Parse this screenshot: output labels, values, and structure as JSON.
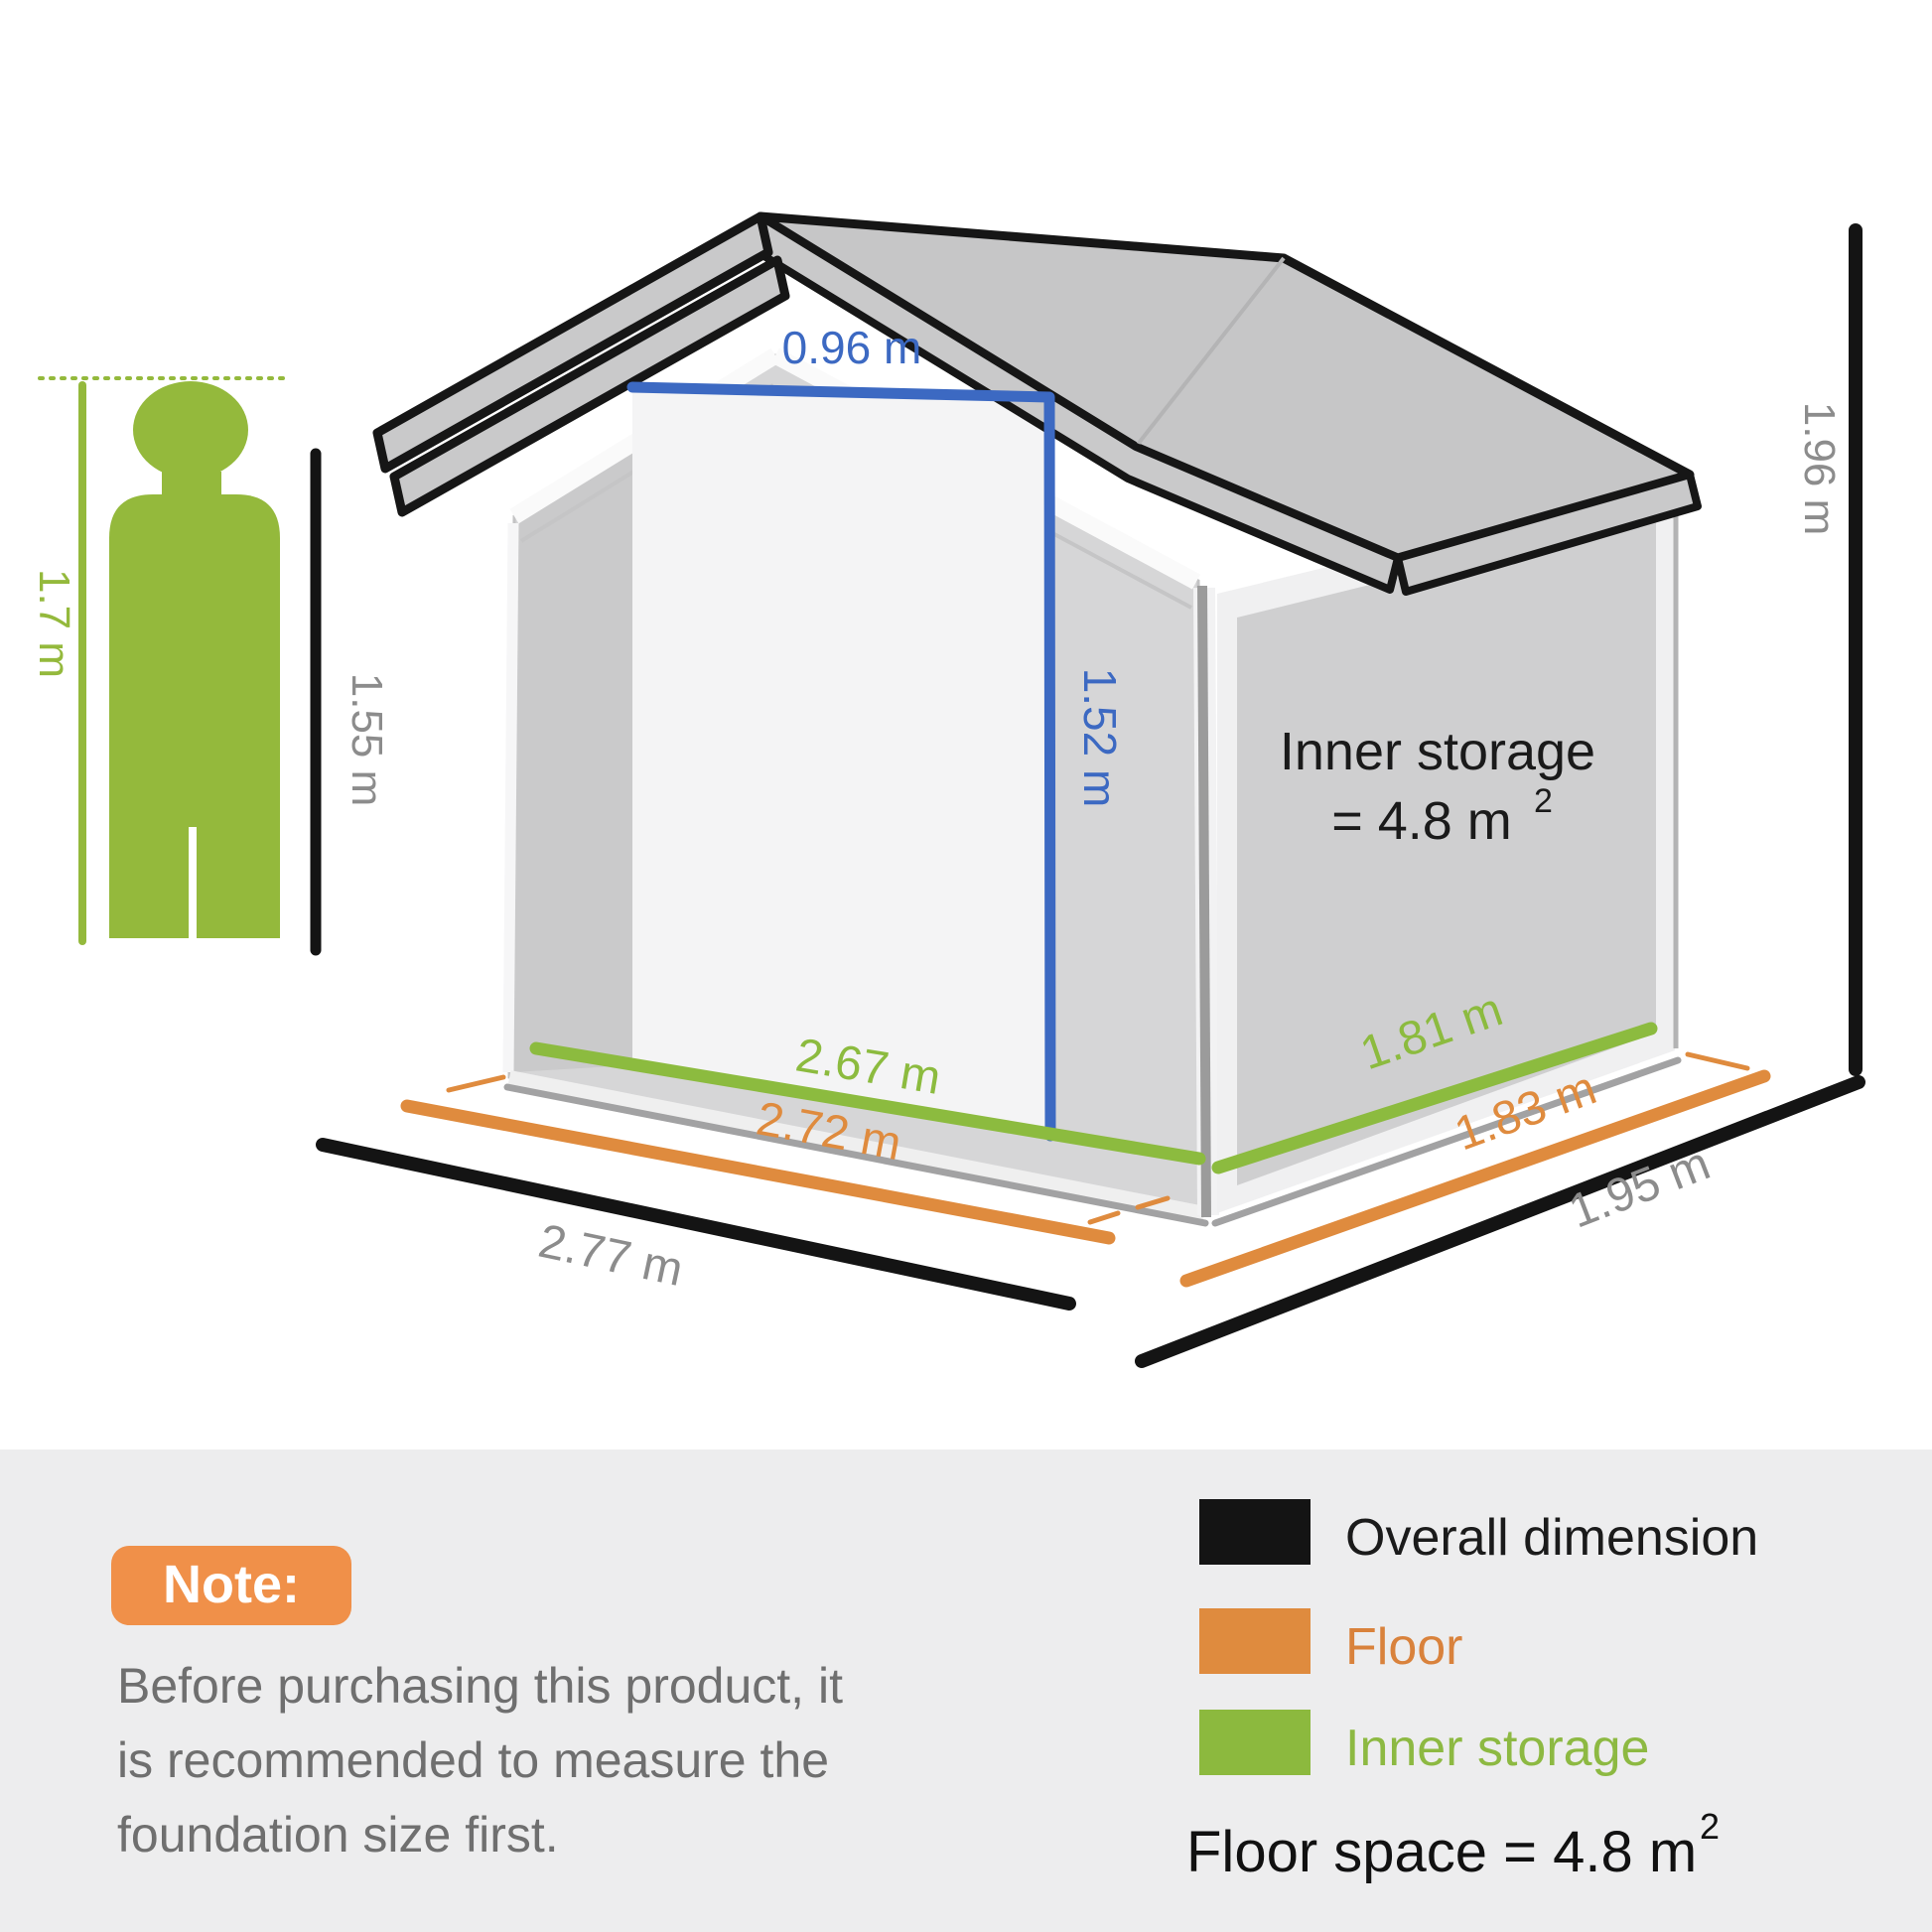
{
  "person": {
    "height_label": "1.7 m"
  },
  "shed": {
    "wall_height_label": "1.55 m",
    "overall_height_label": "1.96 m",
    "door_width_label": "0.96 m",
    "door_height_label": "1.52 m",
    "inner_storage_title": "Inner storage",
    "inner_storage_value": "= 4.8 m",
    "inner_storage_sup": "2",
    "front_inner_width_label": "2.67 m",
    "front_floor_width_label": "2.72 m",
    "front_overall_width_label": "2.77 m",
    "side_inner_depth_label": "1.81 m",
    "side_floor_depth_label": "1.83 m",
    "side_overall_depth_label": "1.95 m"
  },
  "note": {
    "title": "Note:",
    "lines": [
      "Before purchasing this product, it",
      "is recommended to measure the",
      "foundation size first."
    ]
  },
  "legend": {
    "items": [
      {
        "label": "Overall dimension",
        "color": "#141414",
        "text_color": "#1b1b1b"
      },
      {
        "label": "Floor",
        "color": "#df8b3e",
        "text_color": "#d9823c"
      },
      {
        "label": "Inner storage",
        "color": "#8cb93e",
        "text_color": "#8db942"
      }
    ],
    "floor_space_label": "Floor space = 4.8 m",
    "floor_space_sup": "2"
  },
  "colors": {
    "overall": "#141414",
    "floor": "#df8b3e",
    "inner": "#8cbb3f",
    "person_green": "#94b93c",
    "door_accent": "#3c69c2",
    "gray_label": "#8c8c8c",
    "badge": "#f09049",
    "note_bg": "#ededee"
  }
}
